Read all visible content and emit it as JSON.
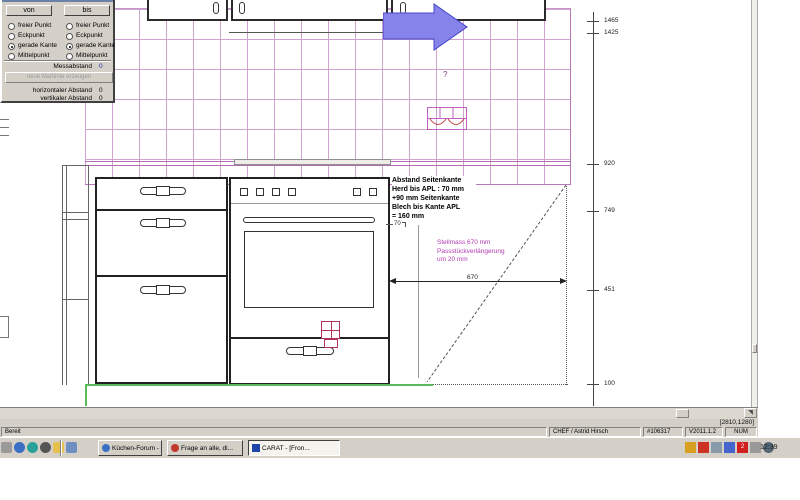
{
  "dialog": {
    "von_button": "von",
    "bis_button": "bis",
    "radios": [
      "freier Punkt",
      "Eckpunkt",
      "gerade Kante",
      "Mittelpunkt"
    ],
    "selected_option": "gerade Kante",
    "messabstand_label": "Messabstand",
    "messabstand_value": "0",
    "create_dimension_button": "neue Maßlinie erzeugen",
    "horizontal_label": "horizontaler Abstand",
    "horizontal_value": "0",
    "vertical_label": "vertikaler Abstand",
    "vertical_value": "0"
  },
  "drawing": {
    "annotation": [
      "Abstand Seitenkante",
      "Herd bis APL : 70 mm",
      "+90 mm Seitenkante",
      "Blech bis Kante APL",
      "= 160 mm"
    ],
    "note_magenta": [
      "Stellmass 670 mm",
      "Passstückverlängerung",
      "um 20 mm"
    ],
    "question_mark": "?",
    "dim_70": "70",
    "dim_670": "670",
    "ruler_ticks": [
      "1465",
      "1425",
      "920",
      "749",
      "451",
      "100"
    ]
  },
  "statusbar": {
    "coords": "[2810,1280]",
    "ready": "Bereit",
    "user": "CHEF / Astrid Hirsch",
    "id": "#106317",
    "version": "V2011.1.2",
    "num": "NUM"
  },
  "taskbar": {
    "buttons": [
      {
        "label": "Küchen-Forum - ..."
      },
      {
        "label": "Frage an alle, di..."
      },
      {
        "label": "CARAT - [Fron..."
      }
    ],
    "tray_badge": "2",
    "clock": "12:39"
  },
  "colors": {
    "tile_grid": "#cfa3cf",
    "arrow_blue": "#8684ea",
    "note_magenta": "#b23ab2",
    "plinth_green": "#5abb5a",
    "chrome_gray": "#d4d0c8",
    "symbol_pink": "#b03060"
  }
}
